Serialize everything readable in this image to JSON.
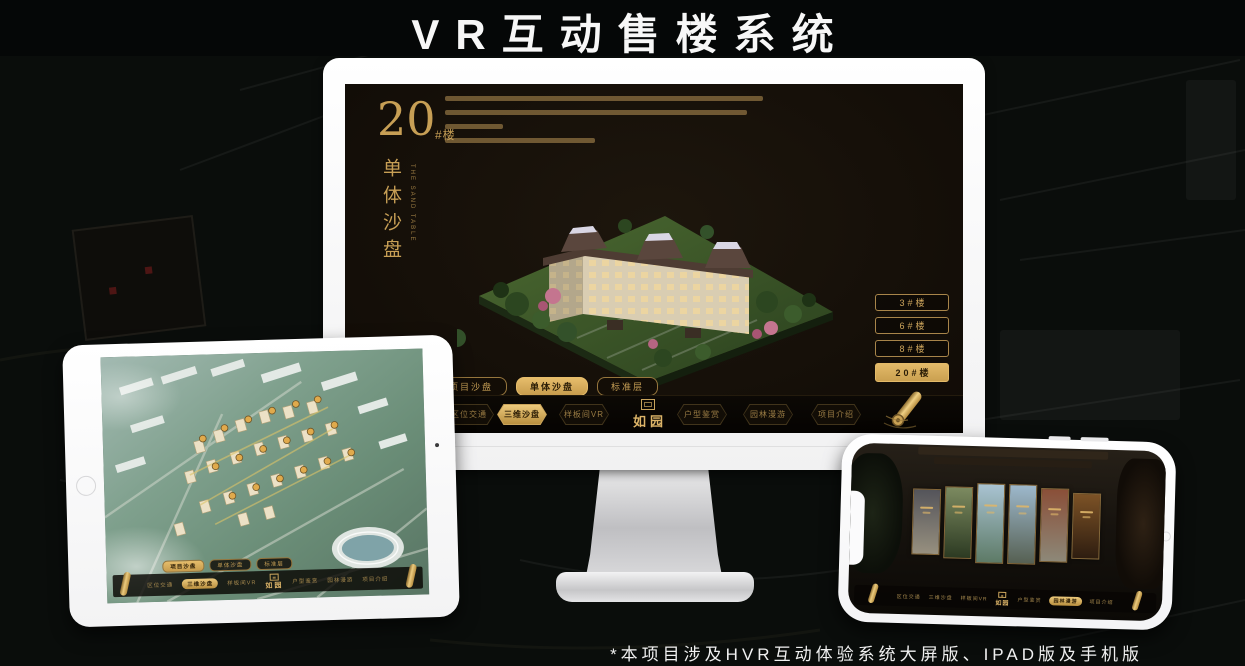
{
  "page": {
    "title": "VR互动售楼系统",
    "footnote": "*本项目涉及HVR互动体验系统大屏版、IPAD版及手机版"
  },
  "app": {
    "logo_text": "如园",
    "view_tabs": [
      "项目沙盘",
      "单体沙盘",
      "标准层"
    ],
    "nav_items": [
      "区位交通",
      "三维沙盘",
      "样板间VR",
      "户型鉴赏",
      "园林漫游",
      "项目介绍"
    ]
  },
  "monitor_screen": {
    "building_no": "20",
    "building_no_suffix": "#楼",
    "subtitle": "单体沙盘",
    "subtitle_en": "THE SAND TABLE",
    "floor_buttons": [
      "3#楼",
      "6#楼",
      "8#楼",
      "20#楼"
    ],
    "selected_floor": "20#楼",
    "selected_tab": "单体沙盘",
    "selected_nav": "三维沙盘"
  },
  "tablet_screen": {
    "selected_tab": "项目沙盘",
    "selected_nav": "三维沙盘"
  },
  "phone_screen": {
    "selected_nav": "园林漫游",
    "gallery_panels": [
      "ink-sketch",
      "courtyard",
      "sky-render",
      "tower-render",
      "autumn-scene",
      "interior-shelf"
    ]
  },
  "colors": {
    "gold": "#cda55c",
    "gold_bright": "#e7c172",
    "screen_bg": "#17110a",
    "title_text": "#f7f7f7"
  }
}
